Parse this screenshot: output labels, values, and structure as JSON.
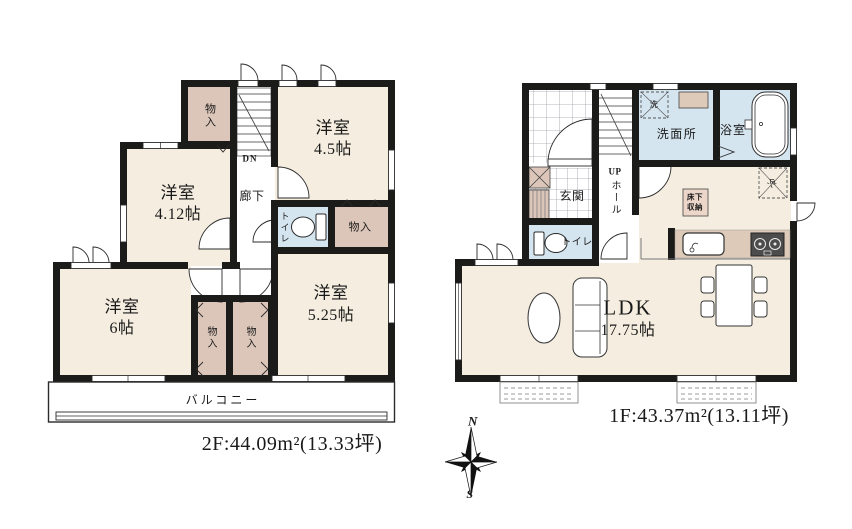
{
  "floor2": {
    "area_label": "2F:44.09m²(13.33坪)",
    "labels": {
      "closet_top": "物入",
      "stairs_dn": "DN",
      "room45_name": "洋室",
      "room45_size": "4.5帖",
      "hallway": "廊下",
      "toilet": "トイレ",
      "closet_mid": "物入",
      "room412_name": "洋室",
      "room412_size": "4.12帖",
      "room6_name": "洋室",
      "room6_size": "6帖",
      "room525_name": "洋室",
      "room525_size": "5.25帖",
      "closet_b1": "物入",
      "closet_b2": "物入",
      "balcony": "バルコニー"
    }
  },
  "floor1": {
    "area_label": "1F:43.37m²(13.11坪)",
    "labels": {
      "genkan": "玄関",
      "up": "UP",
      "hall": "ホール",
      "washer": "洗",
      "washroom": "洗面所",
      "bath": "浴室",
      "toilet": "トイレ",
      "underfloor_line1": "床下",
      "underfloor_line2": "収納",
      "fridge": "冷",
      "ldk_name": "LDK",
      "ldk_size": "17.75帖"
    }
  },
  "compass": {
    "north": "N",
    "south": "S"
  },
  "colors": {
    "wall": "#1b1b19",
    "room": "#f5eee0",
    "closet": "#dcc6b9",
    "wet": "#d5e5f0",
    "counter": "#decab9",
    "tile": "#9aa0a6",
    "line": "#3a3a3a"
  }
}
